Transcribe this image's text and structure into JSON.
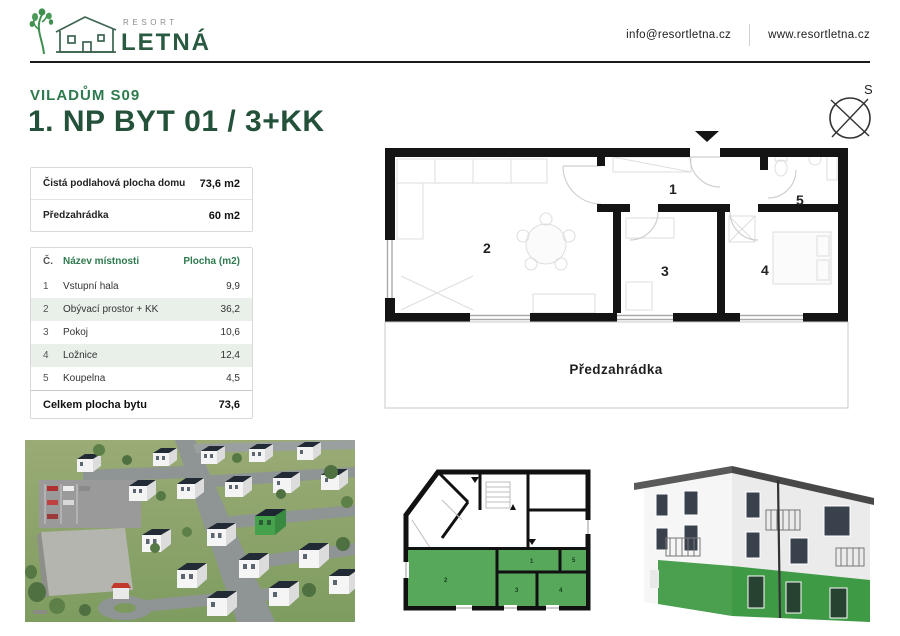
{
  "brand": {
    "resort": "RESORT",
    "name": "LETNÁ"
  },
  "header": {
    "email": "info@resortletna.cz",
    "website": "www.resortletna.cz"
  },
  "title": {
    "subtitle": "VILADŮM S09",
    "heading": "1. NP BYT 01 / 3+KK"
  },
  "summary": {
    "rows": [
      {
        "label": "Čistá podlahová plocha domu",
        "value": "73,6 m2"
      },
      {
        "label": "Předzahrádka",
        "value": "60 m2"
      }
    ]
  },
  "rooms": {
    "headers": {
      "num": "Č.",
      "name": "Název místnosti",
      "area": "Plocha (m2)"
    },
    "rows": [
      {
        "num": "1",
        "name": "Vstupní hala",
        "area": "9,9"
      },
      {
        "num": "2",
        "name": "Obývací prostor + KK",
        "area": "36,2"
      },
      {
        "num": "3",
        "name": "Pokoj",
        "area": "10,6"
      },
      {
        "num": "4",
        "name": "Ložnice",
        "area": "12,4"
      },
      {
        "num": "5",
        "name": "Koupelna",
        "area": "4,5"
      }
    ],
    "footer": {
      "label": "Celkem plocha bytu",
      "value": "73,6"
    }
  },
  "floorplan": {
    "compass": "S",
    "garden_label": "Předzahrádka",
    "room_numbers": [
      "1",
      "2",
      "3",
      "4",
      "5"
    ]
  },
  "colors": {
    "brand_green": "#2e7a4e",
    "dark_green": "#24513a",
    "highlight_green": "#57a85a",
    "table_alt_row": "#e9f0ea",
    "wall_black": "#141414"
  }
}
